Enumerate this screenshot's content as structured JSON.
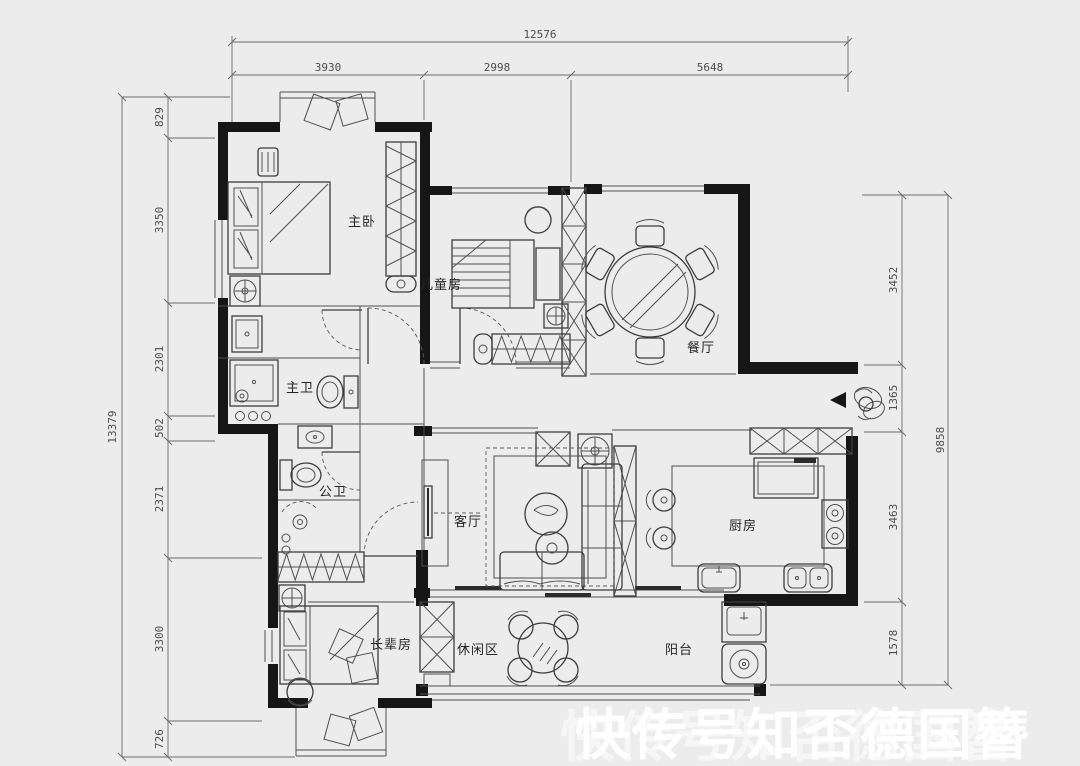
{
  "page": {
    "background": "#ececec",
    "wall_color": "#161616",
    "line_color": "#4f4f4f",
    "watermark_color": "#ffffff"
  },
  "dims": {
    "top_total": "12576",
    "top_segments": [
      "3930",
      "2998",
      "5648"
    ],
    "left_total": "13379",
    "left_segments": [
      "829",
      "3350",
      "2301",
      "502",
      "2371",
      "3300",
      "726"
    ],
    "right_total": "9858",
    "right_segments": [
      "3452",
      "1365",
      "3463",
      "1578"
    ]
  },
  "rooms": {
    "master_bedroom": "主卧",
    "kids_room": "儿童房",
    "dining": "餐厅",
    "master_bath": "主卫",
    "guest_bath": "公卫",
    "living": "客厅",
    "kitchen": "厨房",
    "elder_room": "长辈房",
    "leisure": "休闲区",
    "balcony": "阳台"
  },
  "symbols": {
    "ceiling_fan": "circle-cross-icon",
    "entry_arrow": "left-triangle-icon",
    "entry_plant": "plant-icon",
    "wardrobe_hatch": "zigzag-hatch",
    "cabinet_hatch": "x-lattice"
  },
  "watermark": "快传号知否德国簪"
}
